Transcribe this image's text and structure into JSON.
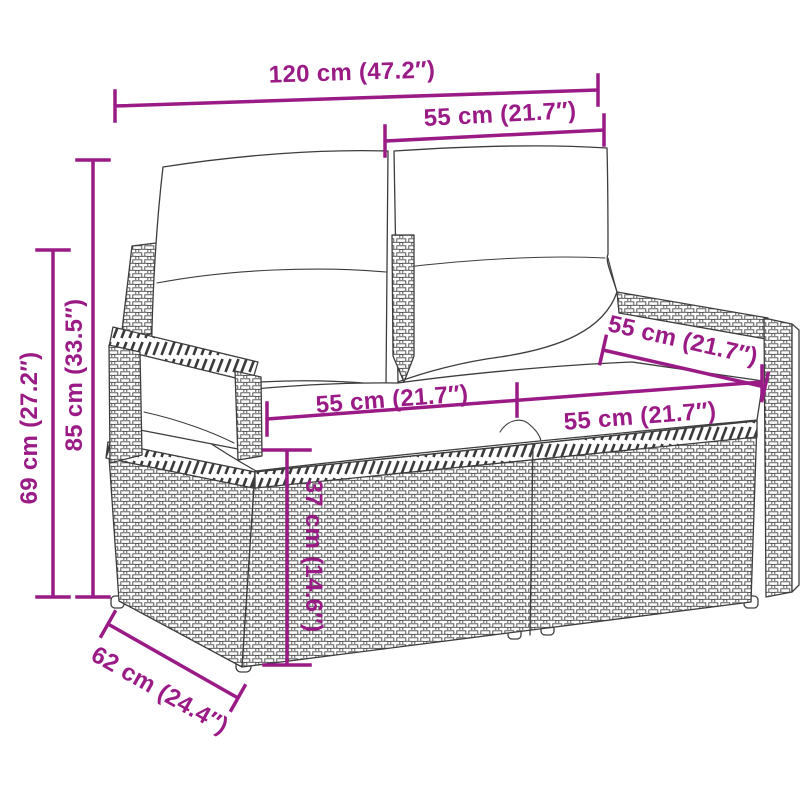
{
  "accent_color": "#9a1a86",
  "line_color": "#3d3d3d",
  "dimensions": {
    "overall_width": "120 cm (47.2″)",
    "backrest_width": "55 cm (21.7″)",
    "overall_height": "85 cm (33.5″)",
    "armrest_height": "69 cm (27.2″)",
    "seat_width_left": "55 cm (21.7″)",
    "seat_width_right": "55 cm (21.7″)",
    "seat_depth": "55 cm (21.7″)",
    "seat_height": "37 cm (14.6″)",
    "overall_depth": "62 cm (24.4″)"
  }
}
